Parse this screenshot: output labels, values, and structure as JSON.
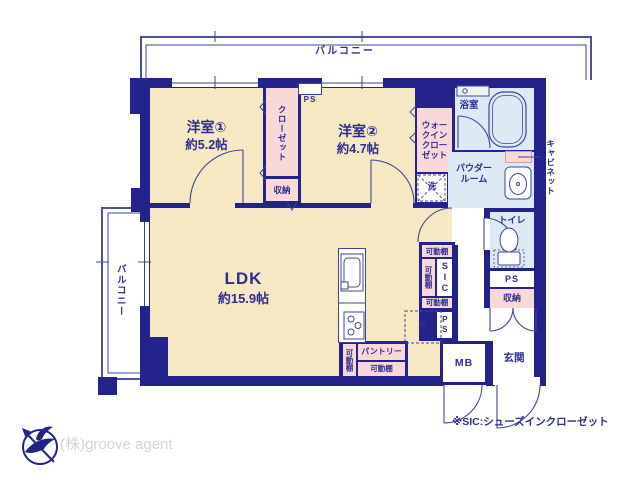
{
  "colors": {
    "wall": "#23238b",
    "floor_room": "#f7e8c4",
    "floor_closet": "#f8d8d8",
    "floor_wet": "#dde9f3",
    "line": "#3f4496",
    "text": "#2d2d8e",
    "logo_text": "#d4d4d4"
  },
  "balcony_top": "バルコニー",
  "balcony_left": "バルコニー",
  "rooms": {
    "room1_name": "洋室①",
    "room1_size": "約5.2帖",
    "room2_name": "洋室②",
    "room2_size": "約4.7帖",
    "ldk_name": "LDK",
    "ldk_size": "約15.9帖",
    "closet": "クローゼット",
    "storage1": "収納",
    "ps_top": "PS",
    "wic": "ウォークインクローゼット",
    "washer": "洗",
    "bath": "浴室",
    "powder": "パウダールーム",
    "cabinet": "キャビネット",
    "toilet": "トイレ",
    "ps_right": "PS",
    "storage2": "収納",
    "shelf": "可動棚",
    "sic": "SIC",
    "ps_sic": "PS",
    "pantry": "パントリー",
    "fridge": "冷",
    "mb": "MB",
    "entrance": "玄関"
  },
  "footer": {
    "note": "※SIC:シューズインクローゼット",
    "agency": "(株)groove agent"
  }
}
